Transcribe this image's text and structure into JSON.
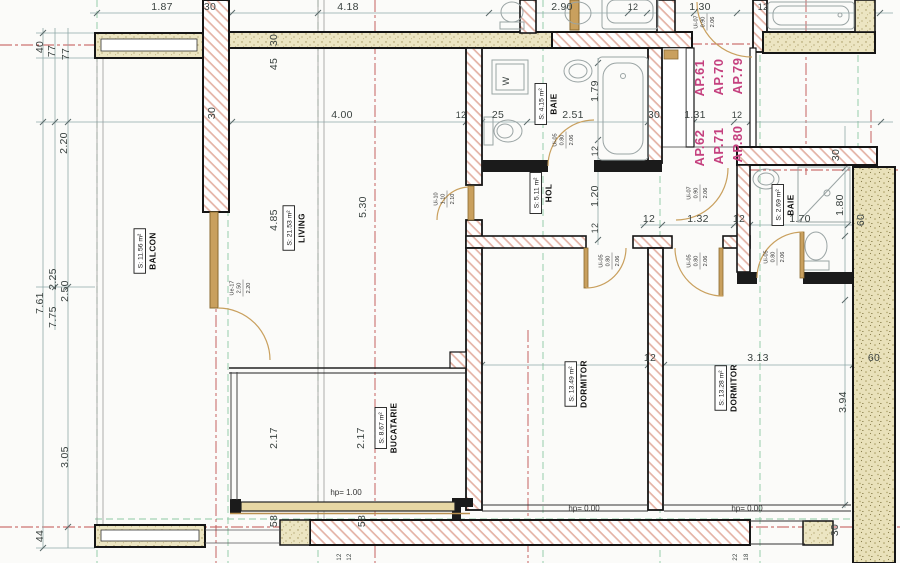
{
  "plan": {
    "colors": {
      "ap_label": "#c5417f",
      "hatch_line": "#dca698",
      "stipple_bg": "#ece5c2",
      "sand_bg": "#e9e1ba",
      "door_wood": "#c9a05e",
      "dim_line": "#8fa8a8",
      "axis_green": "#8cc9a4",
      "centerline_red": "#c05050",
      "wall_outline": "#151515"
    },
    "apartments": {
      "color": "#c5417f",
      "items": [
        {
          "label": "AP.61",
          "x": 704,
          "y": 78
        },
        {
          "label": "AP.70",
          "x": 723,
          "y": 77
        },
        {
          "label": "AP.79",
          "x": 742,
          "y": 76
        },
        {
          "label": "AP.62",
          "x": 704,
          "y": 148
        },
        {
          "label": "AP.71",
          "x": 723,
          "y": 146
        },
        {
          "label": "AP.80",
          "x": 742,
          "y": 144
        }
      ]
    },
    "rooms": [
      {
        "name": "BALCON",
        "area": "S: 11.56 m²",
        "cx": 148,
        "cy": 251
      },
      {
        "name": "LIVING",
        "area": "S: 21.53 m²",
        "cx": 297,
        "cy": 228
      },
      {
        "name": "BUCATARIE",
        "area": "S: 8.67 m²",
        "cx": 389,
        "cy": 428
      },
      {
        "name": "DORMITOR",
        "area": "S: 13.49 m²",
        "cx": 579,
        "cy": 384
      },
      {
        "name": "DORMITOR",
        "area": "S: 13.28 m²",
        "cx": 729,
        "cy": 388
      },
      {
        "name": "BAIE",
        "area": "S: 4.15 m²",
        "cx": 549,
        "cy": 104
      },
      {
        "name": "HOL",
        "area": "S: 5.11 m²",
        "cx": 544,
        "cy": 193
      },
      {
        "name": "BAIE",
        "area": "S: 2.69 m²",
        "cx": 786,
        "cy": 205
      }
    ],
    "doors": [
      {
        "code": "Ue-17",
        "wd": "2.50",
        "ht": "2.20",
        "x": 243,
        "y": 288
      },
      {
        "code": "Ui-10",
        "wd": "1.10",
        "ht": "2.10",
        "x": 447,
        "y": 199
      },
      {
        "code": "Ui-05",
        "wd": "0.80",
        "ht": "2.06",
        "x": 566,
        "y": 140
      },
      {
        "code": "Ui-07",
        "wd": "0.90",
        "ht": "2.06",
        "x": 707,
        "y": 22
      },
      {
        "code": "Ui-07",
        "wd": "0.90",
        "ht": "2.06",
        "x": 700,
        "y": 193
      },
      {
        "code": "Ui-05",
        "wd": "0.80",
        "ht": "2.06",
        "x": 612,
        "y": 261
      },
      {
        "code": "Ui-05",
        "wd": "0.80",
        "ht": "2.06",
        "x": 700,
        "y": 261
      },
      {
        "code": "Ui-05",
        "wd": "0.80",
        "ht": "2.06",
        "x": 777,
        "y": 257
      }
    ],
    "levels": [
      {
        "t": "hp= 1.00",
        "x": 346,
        "y": 495
      },
      {
        "t": "hp= 0.00",
        "x": 584,
        "y": 511
      },
      {
        "t": "hp= 0.00",
        "x": 747,
        "y": 511
      }
    ],
    "dims": [
      {
        "t": "1.87",
        "x": 162,
        "y": 10
      },
      {
        "t": "30",
        "x": 210,
        "y": 10
      },
      {
        "t": "4.18",
        "x": 348,
        "y": 10
      },
      {
        "t": "2.90",
        "x": 562,
        "y": 10
      },
      {
        "t": "12",
        "x": 633,
        "y": 10,
        "s": 9
      },
      {
        "t": "1.30",
        "x": 700,
        "y": 10
      },
      {
        "t": "12",
        "x": 763,
        "y": 10,
        "s": 9
      },
      {
        "t": "4.00",
        "x": 342,
        "y": 118
      },
      {
        "t": "12",
        "x": 461,
        "y": 118,
        "s": 9
      },
      {
        "t": "25",
        "x": 498,
        "y": 118
      },
      {
        "t": "2.51",
        "x": 573,
        "y": 118
      },
      {
        "t": "30",
        "x": 654,
        "y": 118
      },
      {
        "t": "1.31",
        "x": 695,
        "y": 118
      },
      {
        "t": "12",
        "x": 737,
        "y": 118,
        "s": 9
      },
      {
        "t": "12",
        "x": 649,
        "y": 222
      },
      {
        "t": "1.32",
        "x": 698,
        "y": 222
      },
      {
        "t": "12",
        "x": 739,
        "y": 222
      },
      {
        "t": "1.70",
        "x": 800,
        "y": 222
      },
      {
        "t": "12",
        "x": 650,
        "y": 361
      },
      {
        "t": "3.13",
        "x": 758,
        "y": 361
      },
      {
        "t": "60",
        "x": 874,
        "y": 361
      },
      {
        "t": "40",
        "x": 43,
        "y": 47,
        "r": -90
      },
      {
        "t": "77",
        "x": 55,
        "y": 51,
        "r": -90
      },
      {
        "t": "77",
        "x": 69,
        "y": 54,
        "r": -90
      },
      {
        "t": "2.20",
        "x": 67,
        "y": 143,
        "r": -90
      },
      {
        "t": "30",
        "x": 215,
        "y": 113,
        "r": -90
      },
      {
        "t": "30",
        "x": 277,
        "y": 40,
        "r": -90
      },
      {
        "t": "45",
        "x": 277,
        "y": 64,
        "r": -90
      },
      {
        "t": "2.50",
        "x": 68,
        "y": 291,
        "r": -90
      },
      {
        "t": "2.25",
        "x": 56,
        "y": 279,
        "r": -90
      },
      {
        "t": "7.75",
        "x": 56,
        "y": 317,
        "r": -90
      },
      {
        "t": "7.61",
        "x": 43,
        "y": 303,
        "r": -90
      },
      {
        "t": "3.05",
        "x": 68,
        "y": 457,
        "r": -90
      },
      {
        "t": "44",
        "x": 43,
        "y": 536,
        "r": -90
      },
      {
        "t": "4.85",
        "x": 277,
        "y": 220,
        "r": -90
      },
      {
        "t": "5.30",
        "x": 366,
        "y": 207,
        "r": -90
      },
      {
        "t": "1.79",
        "x": 598,
        "y": 91,
        "r": -90
      },
      {
        "t": "12",
        "x": 598,
        "y": 151,
        "r": -90,
        "s": 9
      },
      {
        "t": "1.20",
        "x": 598,
        "y": 196,
        "r": -90
      },
      {
        "t": "12",
        "x": 598,
        "y": 228,
        "r": -90,
        "s": 9
      },
      {
        "t": "2.17",
        "x": 277,
        "y": 438,
        "r": -90
      },
      {
        "t": "2.17",
        "x": 364,
        "y": 438,
        "r": -90
      },
      {
        "t": "58",
        "x": 277,
        "y": 521,
        "r": -90
      },
      {
        "t": "58",
        "x": 365,
        "y": 521,
        "r": -90
      },
      {
        "t": "1.80",
        "x": 843,
        "y": 205,
        "r": -90
      },
      {
        "t": "30",
        "x": 839,
        "y": 155,
        "r": -90
      },
      {
        "t": "3.94",
        "x": 846,
        "y": 402,
        "r": -90
      },
      {
        "t": "30",
        "x": 838,
        "y": 530,
        "r": -90
      },
      {
        "t": "60",
        "x": 864,
        "y": 220,
        "r": -90
      },
      {
        "t": "12",
        "x": 341,
        "y": 557,
        "r": -90,
        "s": 6
      },
      {
        "t": "12",
        "x": 351,
        "y": 557,
        "r": -90,
        "s": 6
      },
      {
        "t": "22",
        "x": 737,
        "y": 557,
        "r": -90,
        "s": 6
      },
      {
        "t": "18",
        "x": 748,
        "y": 557,
        "r": -90,
        "s": 6
      },
      {
        "t": "W",
        "x": 509,
        "y": 81,
        "r": -90,
        "s": 9
      }
    ]
  }
}
